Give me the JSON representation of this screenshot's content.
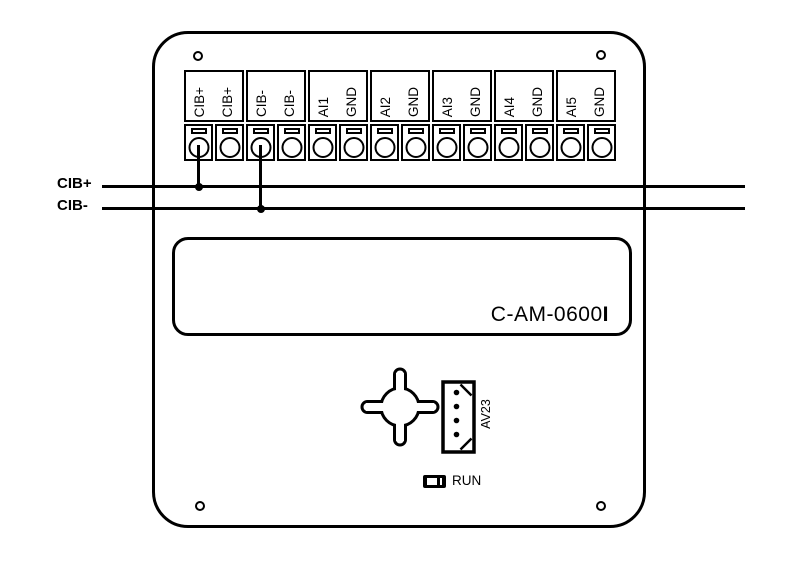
{
  "diagram": {
    "device_model": "C-AM-0600",
    "device_model_suffix": "I",
    "connector_label": "AV23",
    "led_label": "RUN",
    "bus_wires": [
      {
        "label": "CIB+"
      },
      {
        "label": "CIB-"
      }
    ],
    "terminal_labels": [
      "CIB+",
      "CIB+",
      "CIB-",
      "CIB-",
      "AI1",
      "GND",
      "AI2",
      "GND",
      "AI3",
      "GND",
      "AI4",
      "GND",
      "AI5",
      "GND"
    ],
    "colors": {
      "line": "#000000",
      "background": "#ffffff"
    }
  }
}
